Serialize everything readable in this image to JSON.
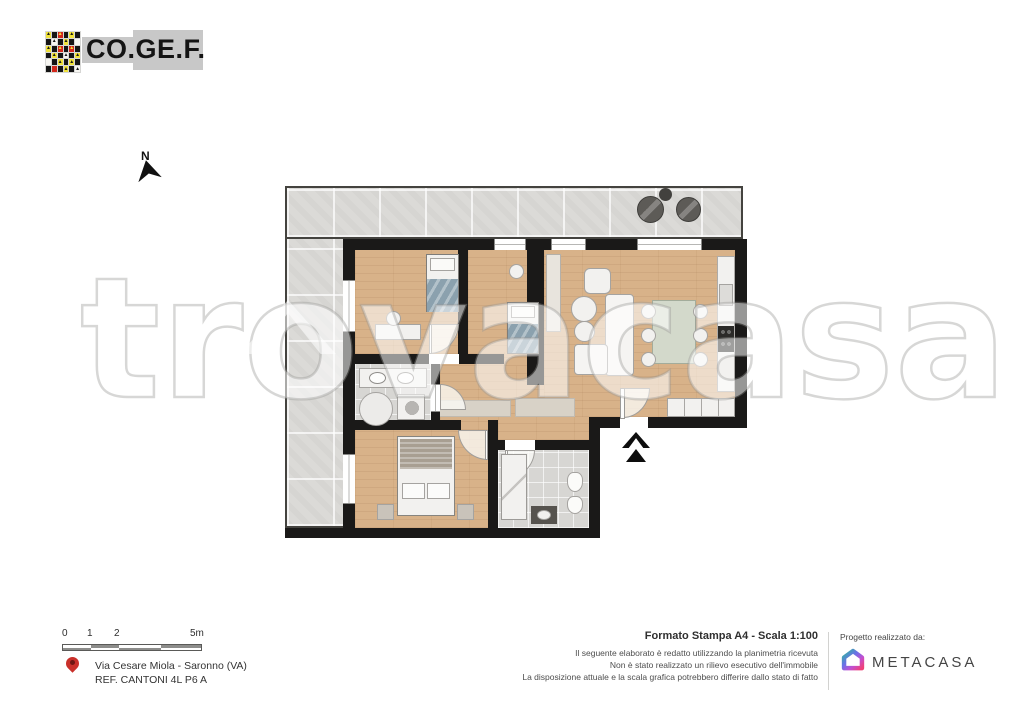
{
  "header": {
    "logo_text": "CO.GE.F.",
    "mosaic": [
      "y^",
      "b",
      "r^",
      "b",
      "y^",
      "b",
      "b",
      "w^",
      "b",
      "y^",
      "b",
      "w",
      "y^",
      "b",
      "r^",
      "b",
      "r^",
      "b",
      "b",
      "y^",
      "b",
      "w^",
      "b",
      "y^",
      "w",
      "b",
      "y^",
      "b",
      "y^",
      "b",
      "b",
      "r",
      "b",
      "y^",
      "b",
      "w^"
    ],
    "mosaic_colors": {
      "y": "#f0e23b",
      "b": "#151515",
      "r": "#d3281c",
      "w": "#f7f6f2"
    }
  },
  "north": {
    "label": "N"
  },
  "watermark": {
    "text": "trovacasa"
  },
  "scalebar": {
    "ticks": [
      "0",
      "1",
      "2",
      "5m"
    ]
  },
  "address": {
    "line1": "Via Cesare Miola - Saronno (VA)",
    "line2": "REF. CANTONI 4L P6 A"
  },
  "print_info": {
    "title": "Formato Stampa A4 - Scala 1:100",
    "disclaimer": [
      "Il seguente elaborato è redatto utilizzando la planimetria ricevuta",
      "Non è stato realizzato un rilievo esecutivo dell'immobile",
      "La disposizione attuale e la scala grafica potrebbero differire dallo stato di fatto"
    ]
  },
  "credits": {
    "label": "Progetto realizzato da:",
    "brand": "METACASA"
  },
  "colors": {
    "wall": "#1a1918",
    "wood": "#d8b289",
    "terrace": "#dbdad7",
    "accent_pin": "#c9302a",
    "blanket": "#8ba1ae",
    "meta_gradient": [
      "#2eb49e",
      "#6a71e8",
      "#c44ed0",
      "#ef4178"
    ]
  }
}
